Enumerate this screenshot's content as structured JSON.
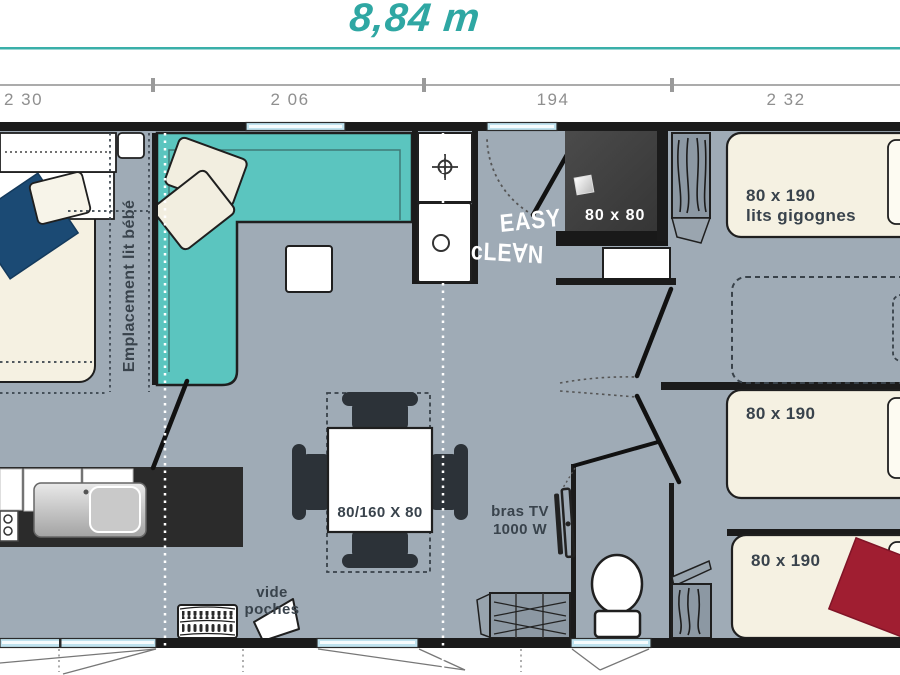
{
  "title": {
    "text": "8,84 m"
  },
  "dims": {
    "segments": [
      {
        "label": "2 30"
      },
      {
        "label": "2 06"
      },
      {
        "label": "194"
      },
      {
        "label": "2 32"
      }
    ]
  },
  "plan": {
    "baby_zone": "Emplacement lit bébé",
    "shower_size": "80 x 80",
    "easy_line1": "EASY",
    "easy_line2": "cLE∀N",
    "bunk_size": "80 x 190",
    "bunk_type": "lits gigognes",
    "bed_mid_size": "80 x 190",
    "bed_bottom_size": "80 x 190",
    "table_size": "80/160 X 80",
    "tv_line1": "bras TV",
    "tv_line2": "1000 W",
    "shelf_line1": "vide",
    "shelf_line2": "poches"
  },
  "icons": {
    "crosshair": "burner-crosshair-icon",
    "basin": "washbasin-circle-icon",
    "hangers": "wardrobe-hanger-icon",
    "slats": "slatted-rack-icon"
  },
  "colors": {
    "accent_teal": "#2FA7A3",
    "rule_teal": "#3AAFA9",
    "floor": "#9FABB6",
    "wall": "#1B1B1B",
    "sofa": "#5BC5BF",
    "bed_cream": "#F5F1E2",
    "navy_throw": "#1B4A74",
    "red_throw": "#A01E31",
    "shower_dark": "#3C3C3C",
    "window_blue": "#BFE2EE",
    "counter_dark": "#2B2B2B",
    "wardrobe_gray": "#8C98A3",
    "label_dark": "#39434C",
    "dim_gray": "#8F8F8F"
  }
}
